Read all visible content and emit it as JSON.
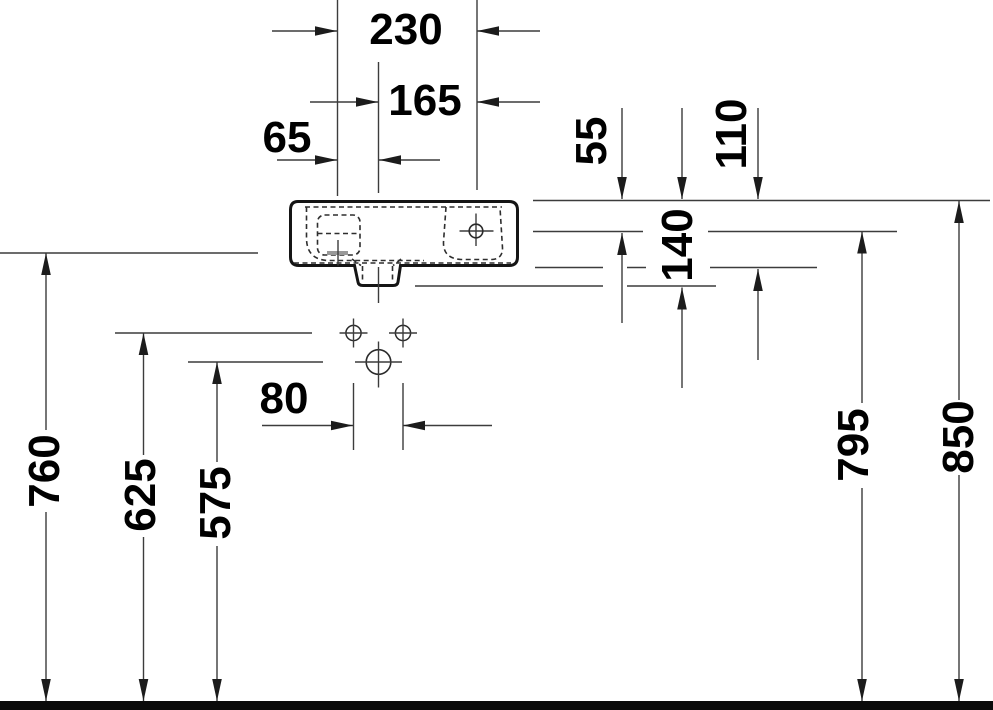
{
  "figure": {
    "type": "washbasin-dimension-drawing"
  },
  "colors": {
    "thin_line": "#3c3c3c",
    "outline": "#151515",
    "text": "#000000",
    "overflow_slot": "#999999",
    "background": "#ffffff"
  },
  "dimensions": {
    "d230": "230",
    "d165": "165",
    "d65": "65",
    "d55": "55",
    "d110": "110",
    "d140": "140",
    "d80": "80",
    "d760": "760",
    "d625": "625",
    "d575": "575",
    "d795": "795",
    "d850": "850"
  }
}
